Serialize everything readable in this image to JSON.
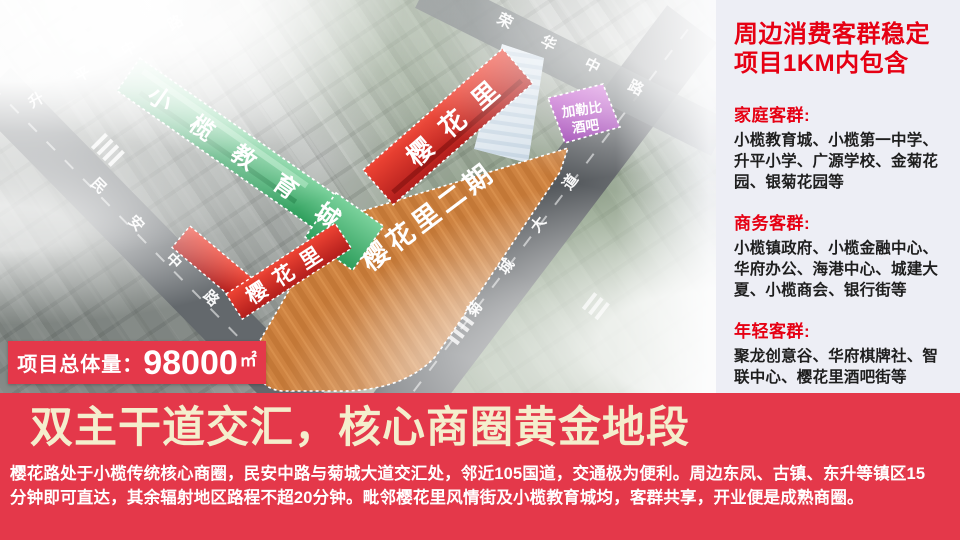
{
  "map": {
    "roads": [
      {
        "name": "升平中路"
      },
      {
        "name": "民安中路"
      },
      {
        "name": "菊城大道"
      },
      {
        "name": "荣华中路"
      }
    ],
    "areas": {
      "education_city": {
        "label": "小榄教育城",
        "color": "#3fae6e"
      },
      "sakura_lane_north": {
        "label": "樱花里",
        "color": "#d92b26"
      },
      "sakura_lane_west": {
        "label": "樱花里",
        "color": "#d92b26"
      },
      "sakura_phase2": {
        "label": "樱花里二期",
        "color": "#cd8040"
      },
      "caribbean_bar": {
        "label_line1": "加勒比",
        "label_line2": "酒吧",
        "color": "#b244c0"
      }
    },
    "volume_badge": {
      "label": "项目总体量：",
      "value": "98000",
      "unit": "㎡"
    }
  },
  "side_panel": {
    "title_line1": "周边消费客群稳定",
    "title_line2": "项目1KM内包含",
    "sections": [
      {
        "heading": "家庭客群:",
        "body": "小榄教育城、小榄第一中学、升平小学、广源学校、金菊花园、银菊花园等"
      },
      {
        "heading": "商务客群:",
        "body": "小榄镇政府、小榄金融中心、华府办公、海港中心、城建大夏、小榄商会、银行街等"
      },
      {
        "heading": "年轻客群:",
        "body": "聚龙创意谷、华府棋牌社、智联中心、樱花里酒吧街等"
      }
    ]
  },
  "bottom_banner": {
    "headline": "双主干道交汇，核心商圈黄金地段",
    "description_line1": "樱花路处于小榄传统核心商圈，民安中路与菊城大道交汇处，邻近105国道，交通极为便利。周边东凤、古镇、东升等镇区15",
    "description_line2": "分钟即可直达，其余辐射地区路程不超20分钟。毗邻樱花里风情街及小榄教育城均，客群共享，开业便是成熟商圈。"
  },
  "colors": {
    "band_red": "#e4384a",
    "accent_red": "#e60013",
    "headline_cream": "#f4eecd",
    "panel_bg": "#edeef5"
  }
}
